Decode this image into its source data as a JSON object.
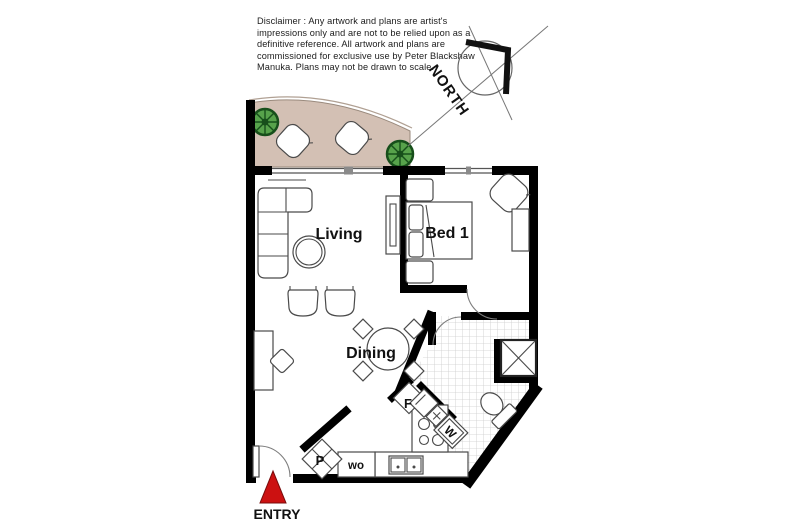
{
  "disclaimer": {
    "lines": [
      "Disclaimer : Any artwork and plans are artist's",
      "impressions only and are not to be relied upon as a",
      "definitive reference. All artwork and plans are",
      "commissioned for exclusive use by Peter Blackshaw",
      "Manuka. Plans may not be drawn to scale."
    ]
  },
  "compass": {
    "label": "NORTH"
  },
  "rooms": {
    "living": "Living",
    "bed1": "Bed 1",
    "dining": "Dining"
  },
  "labels": {
    "fridge": "F",
    "washer": "W",
    "pantry": "P",
    "wall_oven": "wo",
    "entry": "ENTRY"
  },
  "colors": {
    "wall": "#000000",
    "balcony_floor": "#d3c0b4",
    "plant": "#57a24b",
    "plant_dark": "#174f1b",
    "entry_marker": "#cc1111"
  }
}
